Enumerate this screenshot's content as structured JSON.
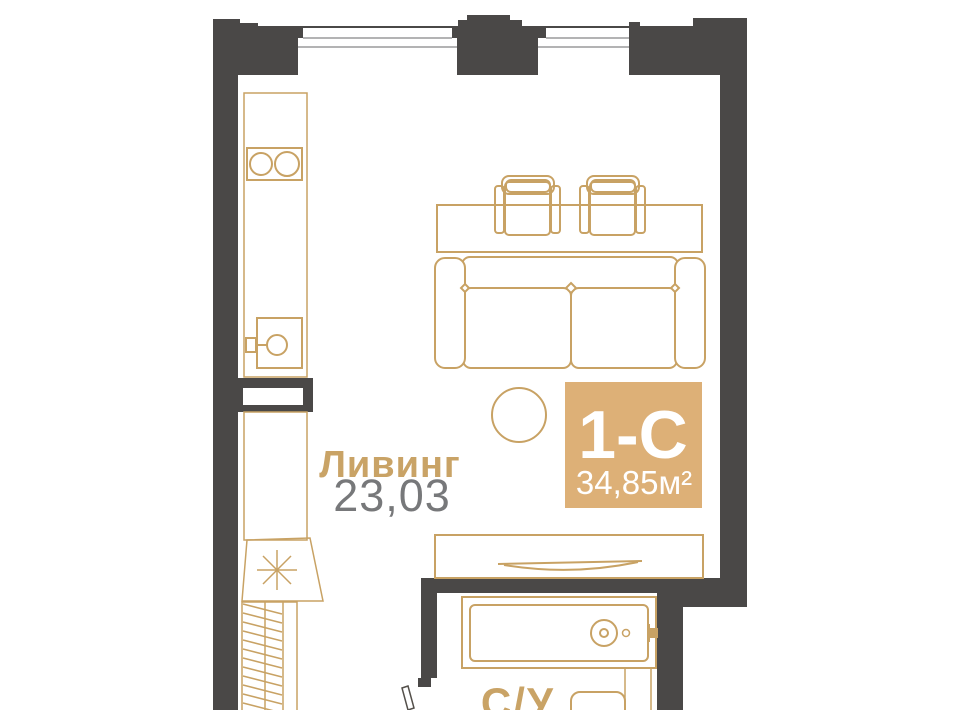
{
  "plan": {
    "room": {
      "label": "Ливинг",
      "area": "23,03"
    },
    "badge": {
      "type": "1-С",
      "area": "34,85м²"
    },
    "bathroom": {
      "label": "С/У"
    }
  },
  "icons": [
    "stove-icon",
    "sink-icon",
    "dining-table-icon",
    "chair-icon",
    "sofa-icon",
    "coffee-table-icon",
    "tv-console-icon",
    "tv-icon",
    "asterisk-appliance-icon",
    "wardrobe-hatch-icon",
    "bathtub-icon",
    "toilet-icon",
    "door-leaf-icon",
    "window-icon"
  ],
  "colors": {
    "wall": "#4a4847",
    "line": "#c8a264",
    "accent": "#ddb077",
    "label_accent": "#c9a366",
    "label_gray": "#77787a",
    "window_line": "#9a9a9b",
    "door_line": "#54504b",
    "bg": "#ffffff"
  }
}
